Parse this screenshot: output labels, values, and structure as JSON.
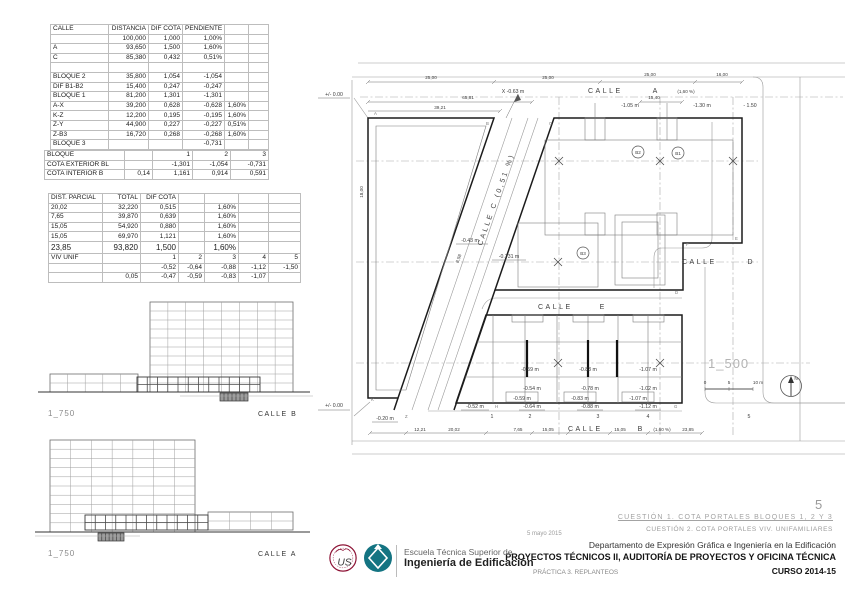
{
  "tables": {
    "streets": {
      "rows": [
        [
          "CALLE",
          "DISTANCIA",
          "DIF COTA",
          "PENDIENTE",
          "",
          ""
        ],
        [
          "",
          "100,000",
          "1,000",
          "1,00%",
          "",
          ""
        ],
        [
          "A",
          "93,650",
          "1,500",
          "1,60%",
          "",
          ""
        ],
        [
          "C",
          "85,380",
          "0,432",
          "0,51%",
          "",
          ""
        ],
        [
          "",
          "",
          "",
          "",
          "",
          ""
        ],
        [
          "BLOQUE 2",
          "35,800",
          "1,054",
          "-1,054",
          "",
          ""
        ],
        [
          "DIF B1-B2",
          "15,400",
          "0,247",
          "-0,247",
          "",
          ""
        ],
        [
          "BLOQUE 1",
          "81,200",
          "1,301",
          "-1,301",
          "",
          ""
        ],
        [
          "A-X",
          "39,200",
          "0,628",
          "-0,628",
          "1,60%",
          ""
        ],
        [
          "K-Z",
          "12,200",
          "0,195",
          "-0,195",
          "1,60%",
          ""
        ],
        [
          "Z-Y",
          "44,900",
          "0,227",
          "-0,227",
          "0,51%",
          ""
        ],
        [
          "Z-B3",
          "16,720",
          "0,268",
          "-0,268",
          "1,60%",
          ""
        ],
        [
          "BLOQUE 3",
          "",
          "",
          "-0,731",
          "",
          ""
        ]
      ]
    },
    "bloques": {
      "rows": [
        [
          "BLOQUE",
          "",
          "1",
          "2",
          "3"
        ],
        [
          "COTA EXTERIOR BL",
          "",
          "-1,301",
          "-1,054",
          "-0,731"
        ],
        [
          "COTA INTERIOR B",
          "0,14",
          "1,161",
          "0,914",
          "0,591"
        ]
      ]
    },
    "parciales": {
      "rows": [
        [
          "DIST. PARCIAL",
          "TOTAL",
          "DIF COTA",
          "",
          "",
          "",
          ""
        ],
        [
          "20,02",
          "32,220",
          "0,515",
          "",
          "1,60%",
          "",
          ""
        ],
        [
          "7,65",
          "39,870",
          "0,639",
          "",
          "1,60%",
          "",
          ""
        ],
        [
          "15,05",
          "54,920",
          "0,880",
          "",
          "1,60%",
          "",
          ""
        ],
        [
          "15,05",
          "69,970",
          "1,121",
          "",
          "1,60%",
          "",
          ""
        ],
        [
          "23,85",
          "93,820",
          "1,500",
          "",
          "1,60%",
          "",
          ""
        ],
        [
          "VIV UNIF",
          "",
          "1",
          "2",
          "3",
          "4",
          "5"
        ],
        [
          "",
          "",
          "-0,52",
          "-0,64",
          "-0,88",
          "-1,12",
          "-1,50"
        ],
        [
          "",
          "0,05",
          "-0,47",
          "-0,59",
          "-0,83",
          "-1,07",
          ""
        ]
      ]
    }
  },
  "elevations": {
    "b": {
      "scale": "1_750",
      "street": "CALLE B"
    },
    "a": {
      "scale": "1_750",
      "street": "CALLE A"
    }
  },
  "plan": {
    "labels": {
      "datum_top": "+/- 0.00",
      "datum_bottom": "+/- 0.00",
      "dim_25a": "25,00",
      "dim_25b": "25,00",
      "dim_25c": "25,00",
      "dim_16": "16,00",
      "dim_6581": "65,81",
      "dim_3921": "39,21",
      "dim_1540": "15,40",
      "dim_1800": "18,00",
      "dim_858": "8,58",
      "x_point": "X  -0.63 m",
      "calle_a_name": "CALLE",
      "calle_a_letter": "A",
      "calle_a_slope": "(1,60 %)",
      "calle_b_name": "CALLE",
      "calle_b_letter": "B",
      "calle_b_slope": "(1,60 %)",
      "calle_c": "CALLE    C   (0,51 %)",
      "calle_d_name": "CALLE",
      "calle_d_letter": "D",
      "calle_e_name": "CALLE",
      "calle_e_letter": "E",
      "m105": "-1.05 m",
      "m130": "-1.30 m",
      "m150": "- 1.50",
      "m043": "-0.43 m",
      "m0731": "-0.731 m",
      "m020": "-0.20 m",
      "h_m059": "-0.59 m",
      "h_m083": "-0.83 m",
      "h_m107": "-1.07 m",
      "h_m054": "-0.54 m",
      "h_m078": "-0.78 m",
      "h_m102": "-1.02 m",
      "box_m059": "-0.59 m",
      "box_m083": "-0.83 m",
      "box_m107": "-1.07 m",
      "r_m052": "-0.52 m",
      "r_m064": "-0.64 m",
      "r_m088": "-0.88 m",
      "r_m112": "-1.12 m",
      "v_a": "A",
      "v_b": "B",
      "v_c": "C",
      "v_d": "D",
      "v_e": "E",
      "v_f": "F",
      "v_g": "G",
      "v_h": "H",
      "v_k": "K",
      "v_z": "Z",
      "b1": "B1",
      "b2": "B2",
      "b3": "B3",
      "n1": "1",
      "n2": "2",
      "n3": "3",
      "n4": "4",
      "n5": "5",
      "bd_1221": "12,21",
      "bd_2002": "20,02",
      "bd_765": "7,65",
      "bd_1505a": "15,05",
      "bd_1505b": "15,05",
      "bd_2385": "23,85",
      "scale": "1_500",
      "sb0": "0",
      "sb5": "5",
      "sb10": "10 m",
      "north": "N"
    }
  },
  "titleblock": {
    "page_number": "5",
    "date": "5 mayo 2015",
    "cuestion1": "CUESTIÓN 1. COTA PORTALES BLOQUES 1, 2 Y 3",
    "cuestion2": "CUESTIÓN 2. COTA PORTALES VIV. UNIFAMILIARES",
    "department": "Departamento de Expresión Gráfica e Ingeniería en la Edificación",
    "course_title": "PROYECTOS TÉCNICOS II, AUDITORÍA DE PROYECTOS Y OFICINA TÉCNICA",
    "practice": "PRÁCTICA 3. REPLANTEOS",
    "curso": "CURSO 2014-15",
    "school_line1": "Escuela Técnica Superior de",
    "school_line2": "Ingeniería de Edificación",
    "seal_text": "US"
  },
  "colors": {
    "seal_red": "#8e1537",
    "logo_teal": "#147482"
  },
  "icons": {
    "north_arrow": "compass-circle-with-needle",
    "university_seal": "us-seal",
    "school_logo": "teal-diamond"
  }
}
